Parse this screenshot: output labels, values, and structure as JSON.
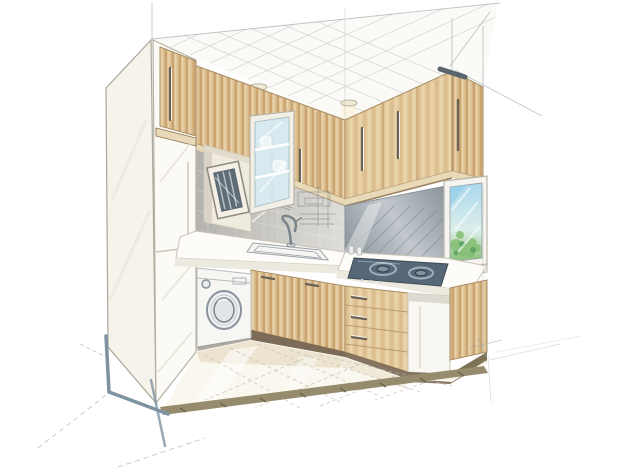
{
  "meta": {
    "title": "Kitchen interior perspective sketch",
    "medium": "pencil line work with watercolor-marker rendering",
    "style": "architectural concept drawing on white paper"
  },
  "scene": {
    "description": "Hand-drawn two-wall perspective of a small L-shaped kitchen: tall white fridge column at left, wood-grain upper and lower cabinets, recessed niche with framed panel, glass-front cabinet, mosaic backsplash with sketched detail lines, sink with gooseneck faucet, stainless backsplash and gas hob on the right run, window with greenery, built-in washing machine, tiled floor, ceiling planks with two downlight cones, and loose pencil construction lines extending past the drawing.",
    "objects": [
      "refrigerator-column",
      "upper-cabinets-left",
      "upper-cabinets-right",
      "niche-framed-panel",
      "glass-front-cabinet",
      "mosaic-backsplash",
      "steel-backsplash",
      "sink",
      "faucet",
      "gas-hob",
      "window-with-plants",
      "washing-machine",
      "base-cabinets",
      "drawer-stack",
      "toe-kick",
      "tiled-floor",
      "ceiling-planks",
      "downlights",
      "construction-lines"
    ]
  },
  "palette": {
    "paper": "#ffffff",
    "ceiling": "#fbfaf6",
    "wood_light": "#ecd7ae",
    "wood_mid": "#d9ba8a",
    "wood_dark": "#c39a66",
    "wood_trim": "#8f6f4c",
    "wood_shelf": "#e8d9b8",
    "cabinet_white": "#fbfaf5",
    "cabinet_side": "#f6f3ea",
    "counter_white": "#fdfcf8",
    "counter_face": "#eceadf",
    "steel_light": "#c2c8cd",
    "steel_dark": "#8b959b",
    "mosaic_light": "#dedcd6",
    "mosaic_dark": "#b4b2ac",
    "hob_dark": "#566878",
    "hob_ring": "#9fb0bc",
    "window_sky": "#a9d8ee",
    "window_mid": "#ddeeea",
    "plant_green": "#86bf75",
    "plant_dark": "#55a05b",
    "niche_fill": "#f0ebdf",
    "frame_screen": "#5f6b75",
    "washer_white": "#f6f6f2",
    "floor_base": "#faf7ef",
    "floor_warm": "#eadfc8",
    "floor_edge": "#968c6d",
    "toe_kick": "#6e5c45",
    "pencil": "#98a0a8",
    "marker_blue": "#7e93a2",
    "marker_dark": "#59646c",
    "light_beam": "#fbf3d3",
    "glass_blue": "#d8eaf0"
  }
}
